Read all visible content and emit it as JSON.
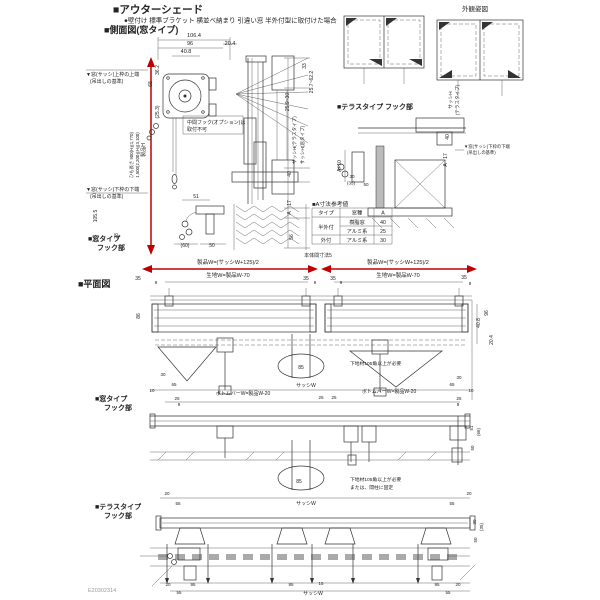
{
  "colors": {
    "accent_red": "#c00000",
    "line": "#2b2b2b",
    "bg": "#ffffff"
  },
  "header": {
    "title": "■アウターシェード",
    "subtitle": "●壁付け 標準ブラケット 横並べ納まり 引違い窓 半外付型に取付けた場合",
    "side_view_heading": "■側面図(窓タイプ)",
    "exterior_view_label": "外観姿図",
    "plan_heading": "■平面図"
  },
  "section_labels": {
    "window_hook_side_line1": "■窓タイプ",
    "window_hook_side_line2": "フック部",
    "terrace_hook_side": "■テラスタイプ フック部",
    "window_hook_plan_line1": "■窓タイプ",
    "window_hook_plan_line2": "フック部",
    "terrace_hook_plan_line1": "■テラスタイプ",
    "terrace_hook_plan_line2": "フック部"
  },
  "table": {
    "title": "■A寸法参考値",
    "headers": [
      "タイプ",
      "窓種",
      "A"
    ],
    "rows": [
      [
        "半外付",
        "樹脂窓",
        "40"
      ],
      [
        "",
        "アルミ系",
        "25"
      ],
      [
        "外付",
        "アルミ系",
        "30"
      ]
    ]
  },
  "footer": {
    "code": "E20302314"
  },
  "labels": [
    {
      "n": "dim-total-depth",
      "t": "106.4",
      "x": 194,
      "y": 37,
      "s": 5.5
    },
    {
      "n": "dim-96",
      "t": "96",
      "x": 190,
      "y": 45,
      "s": 5.5
    },
    {
      "n": "dim-20-4",
      "t": "20.4",
      "x": 230,
      "y": 45,
      "s": 5.5
    },
    {
      "n": "dim-40-8",
      "t": "40.8",
      "x": 186,
      "y": 53,
      "s": 5.5
    },
    {
      "n": "dim-36-2",
      "t": "36.2",
      "x": 159,
      "y": 70,
      "r": -90,
      "s": 5
    },
    {
      "n": "dim-68",
      "t": "68",
      "x": 152,
      "y": 84,
      "r": -90,
      "s": 5
    },
    {
      "n": "dim-25-3",
      "t": "(25.3)",
      "x": 159,
      "y": 112,
      "r": -90,
      "s": 5
    },
    {
      "n": "ref-top-frame-note1",
      "t": "▼窓(サッシ)上枠の上端",
      "x": 86,
      "y": 76,
      "s": 5,
      "a": "start"
    },
    {
      "n": "ref-top-frame-note2",
      "t": "(吊出しの基準)",
      "x": 90,
      "y": 83,
      "s": 5,
      "a": "start"
    },
    {
      "n": "ref-bottom-frame-note1",
      "t": "▼窓(サッシ)下枠の下端",
      "x": 86,
      "y": 191,
      "s": 5,
      "a": "start"
    },
    {
      "n": "ref-bottom-frame-note2",
      "t": "(吊出しの基準)",
      "x": 90,
      "y": 198,
      "s": 5,
      "a": "start"
    },
    {
      "n": "dim-product-height",
      "t": "製品H",
      "x": 145,
      "y": 150,
      "r": -90,
      "s": 5
    },
    {
      "n": "cord-length-note1",
      "t": "ひも長さ 900(H≦1,770)",
      "x": 133,
      "y": 155,
      "r": -90,
      "s": 4.3
    },
    {
      "n": "cord-length-note2",
      "t": "1,500(2,200≦H≦3,100)",
      "x": 139,
      "y": 155,
      "r": -90,
      "s": 4.3
    },
    {
      "n": "dim-105-5",
      "t": "105.5",
      "x": 97,
      "y": 216,
      "r": -90,
      "s": 5
    },
    {
      "n": "dim-28",
      "t": "28",
      "x": 118,
      "y": 236,
      "r": -90,
      "s": 5
    },
    {
      "n": "mid-hook-note1",
      "t": "中間フック(オプション)は",
      "x": 187,
      "y": 124,
      "s": 5,
      "a": "start"
    },
    {
      "n": "mid-hook-note2",
      "t": "取付不可",
      "x": 187,
      "y": 131,
      "s": 5,
      "a": "start"
    },
    {
      "n": "dim-51",
      "t": "51",
      "x": 196,
      "y": 198,
      "s": 5
    },
    {
      "n": "dim-60",
      "t": "(60)",
      "x": 185,
      "y": 247,
      "s": 5
    },
    {
      "n": "dim-50",
      "t": "50",
      "x": 212,
      "y": 247,
      "s": 5
    },
    {
      "n": "dim-33",
      "t": "33",
      "x": 306,
      "y": 66,
      "r": -90,
      "s": 5
    },
    {
      "n": "dim-25-7-62-2",
      "t": "25.7~62.2",
      "x": 313,
      "y": 82,
      "r": -90,
      "s": 5
    },
    {
      "n": "dim-25-9-30",
      "t": "25.9~30",
      "x": 289,
      "y": 102,
      "r": -90,
      "s": 5
    },
    {
      "n": "dim-sash-h-terrace",
      "t": "サッシH(テラスタイプ)",
      "x": 296,
      "y": 140,
      "r": -90,
      "s": 4.6
    },
    {
      "n": "dim-sash-h-window",
      "t": "サッシH(窓タイプ)",
      "x": 304,
      "y": 145,
      "r": -90,
      "s": 4.6
    },
    {
      "n": "dim-40",
      "t": "40",
      "x": 291,
      "y": 174,
      "r": -90,
      "s": 5
    },
    {
      "n": "dim-17",
      "t": "17",
      "x": 291,
      "y": 203,
      "r": -90,
      "s": 5
    },
    {
      "n": "dim-a",
      "t": "A",
      "x": 291,
      "y": 213,
      "r": -90,
      "s": 5
    },
    {
      "n": "dim-56",
      "t": "56",
      "x": 293,
      "y": 237,
      "r": -90,
      "s": 5
    },
    {
      "n": "dim-sash-h-terrace2a",
      "t": "サッシH",
      "x": 452,
      "y": 100,
      "r": -90,
      "s": 4.6
    },
    {
      "n": "dim-sash-h-terrace2b",
      "t": "(テラスタイプ)",
      "x": 459,
      "y": 100,
      "r": -90,
      "s": 4.6
    },
    {
      "n": "dim-t-40",
      "t": "40",
      "x": 449,
      "y": 137,
      "r": -90,
      "s": 5
    },
    {
      "n": "dim-t-17",
      "t": "17",
      "x": 447,
      "y": 156,
      "r": -90,
      "s": 5
    },
    {
      "n": "dim-t-a",
      "t": "A",
      "x": 447,
      "y": 165,
      "r": -90,
      "s": 5
    },
    {
      "n": "dim-a-plus-10",
      "t": "A+10",
      "x": 341,
      "y": 166,
      "r": -90,
      "s": 5
    },
    {
      "n": "t-ref-note1",
      "t": "▼窓(サッシ)下枠の下端",
      "x": 464,
      "y": 148,
      "s": 4.3,
      "a": "start"
    },
    {
      "n": "t-ref-note2",
      "t": "(吊出しの基準)",
      "x": 467,
      "y": 154,
      "s": 4.3,
      "a": "start"
    },
    {
      "n": "dim-t-30",
      "t": "30",
      "x": 352,
      "y": 178,
      "s": 4.5
    },
    {
      "n": "dim-t-35",
      "t": "(35)",
      "x": 351,
      "y": 184.5,
      "s": 4.5
    },
    {
      "n": "dim-t-50",
      "t": "50",
      "x": 366,
      "y": 186,
      "s": 4.5
    },
    {
      "n": "plan-product-w-left",
      "t": "製品W=(サッシW+125)/2",
      "x": 228,
      "y": 264,
      "s": 5.5,
      "c": "red"
    },
    {
      "n": "plan-fabric-w-left",
      "t": "生地W=製品W-70",
      "x": 228,
      "y": 277,
      "s": 5.5
    },
    {
      "n": "plan-product-w-right",
      "t": "製品W=(サッシW+125)/2",
      "x": 398,
      "y": 264,
      "s": 5.5,
      "c": "red"
    },
    {
      "n": "plan-fabric-w-right",
      "t": "生地W=製品W-70",
      "x": 398,
      "y": 277,
      "s": 5.5
    },
    {
      "n": "plan-body-gap",
      "t": "本体間寸法5",
      "x": 318,
      "y": 257,
      "s": 5
    },
    {
      "t": "35",
      "x": 138,
      "y": 280,
      "s": 5,
      "c": "red"
    },
    {
      "t": "35",
      "x": 306,
      "y": 280,
      "s": 5,
      "c": "red"
    },
    {
      "t": "35",
      "x": 333,
      "y": 280,
      "s": 5,
      "c": "red"
    },
    {
      "t": "35",
      "x": 464,
      "y": 279,
      "s": 5,
      "c": "red"
    },
    {
      "t": "9",
      "x": 156,
      "y": 284,
      "s": 4.5
    },
    {
      "t": "9",
      "x": 315,
      "y": 284,
      "s": 4.5
    },
    {
      "t": "9",
      "x": 341,
      "y": 284,
      "s": 4.5
    },
    {
      "t": "9",
      "x": 470,
      "y": 285,
      "s": 4.5
    },
    {
      "n": "dim-86",
      "t": "86",
      "x": 140,
      "y": 316,
      "r": -90,
      "s": 5
    },
    {
      "n": "dim-96b",
      "t": "96",
      "x": 488,
      "y": 313,
      "r": -90,
      "s": 5
    },
    {
      "n": "dim-40-8b",
      "t": "40.8",
      "x": 480,
      "y": 323,
      "r": -90,
      "s": 5
    },
    {
      "n": "dim-20-4b",
      "t": "20.4",
      "x": 493,
      "y": 340,
      "r": -90,
      "s": 5
    },
    {
      "t": "30",
      "x": 163,
      "y": 376,
      "s": 4.5
    },
    {
      "t": "65",
      "x": 174,
      "y": 386,
      "s": 4.5
    },
    {
      "t": "10",
      "x": 152,
      "y": 392,
      "s": 4.5
    },
    {
      "t": "25",
      "x": 177,
      "y": 400,
      "s": 4.5
    },
    {
      "t": "9",
      "x": 179,
      "y": 406,
      "s": 4.5
    },
    {
      "t": "30",
      "x": 459,
      "y": 379,
      "s": 4.5
    },
    {
      "t": "65",
      "x": 452,
      "y": 386,
      "s": 4.5
    },
    {
      "t": "10",
      "x": 471,
      "y": 392,
      "s": 4.5
    },
    {
      "t": "25",
      "x": 459,
      "y": 400,
      "s": 4.5
    },
    {
      "t": "9",
      "x": 458,
      "y": 406,
      "s": 4.5
    },
    {
      "n": "bottom-bar-w-left",
      "t": "ボトムバーW=製品W-20",
      "x": 243,
      "y": 395,
      "s": 5
    },
    {
      "n": "bottom-bar-w-right",
      "t": "ボトムバーW=製品W-20",
      "x": 389,
      "y": 393,
      "s": 5
    },
    {
      "n": "sash-w-row1",
      "t": "サッシW",
      "x": 306,
      "y": 387,
      "s": 5
    },
    {
      "t": "25",
      "x": 321,
      "y": 399,
      "s": 4.5
    },
    {
      "t": "25",
      "x": 334,
      "y": 399,
      "s": 4.5
    },
    {
      "n": "detail-85-row1",
      "t": "85",
      "x": 301,
      "y": 369,
      "s": 5
    },
    {
      "n": "base-note-row1",
      "t": "下地材105角以上が必要",
      "x": 350,
      "y": 365,
      "s": 4.8,
      "a": "start"
    },
    {
      "n": "detail-85-row2",
      "t": "85",
      "x": 299,
      "y": 483,
      "s": 5
    },
    {
      "n": "base-note-row2a",
      "t": "下地材105角以上が必要",
      "x": 350,
      "y": 481,
      "s": 4.8,
      "a": "start"
    },
    {
      "n": "base-note-row2b",
      "t": "または、間柱に固定",
      "x": 350,
      "y": 489,
      "s": 4.8,
      "a": "start"
    },
    {
      "t": "51",
      "x": 473,
      "y": 428,
      "r": -90,
      "s": 4.5
    },
    {
      "t": "(66)",
      "x": 480,
      "y": 432,
      "r": -90,
      "s": 4.5
    },
    {
      "t": "50",
      "x": 474,
      "y": 448,
      "r": -90,
      "s": 4.5
    },
    {
      "t": "20",
      "x": 167,
      "y": 495,
      "s": 4.5
    },
    {
      "t": "55",
      "x": 178,
      "y": 505,
      "s": 4.5
    },
    {
      "t": "20",
      "x": 469,
      "y": 495,
      "s": 4.5
    },
    {
      "t": "55",
      "x": 452,
      "y": 505,
      "s": 4.5
    },
    {
      "n": "sash-w-row2",
      "t": "サッシW",
      "x": 306,
      "y": 505,
      "s": 5
    },
    {
      "t": "30",
      "x": 476,
      "y": 522,
      "r": -90,
      "s": 4.5
    },
    {
      "t": "(35)",
      "x": 483,
      "y": 527,
      "r": -90,
      "s": 4.5
    },
    {
      "t": "50",
      "x": 477,
      "y": 540,
      "r": -90,
      "s": 4.5
    },
    {
      "t": "20",
      "x": 168,
      "y": 586,
      "s": 4.5
    },
    {
      "t": "95",
      "x": 193,
      "y": 586,
      "s": 4.5
    },
    {
      "t": "55",
      "x": 179,
      "y": 594,
      "s": 4.5
    },
    {
      "t": "95",
      "x": 291,
      "y": 586,
      "s": 4.5
    },
    {
      "t": "15",
      "x": 321,
      "y": 585,
      "s": 4.5
    },
    {
      "t": "95",
      "x": 437,
      "y": 586,
      "s": 4.5
    },
    {
      "t": "20",
      "x": 458,
      "y": 586,
      "s": 4.5
    },
    {
      "t": "55",
      "x": 448,
      "y": 594,
      "s": 4.5
    },
    {
      "n": "sash-w-row3",
      "t": "サッシW",
      "x": 313,
      "y": 595,
      "s": 5
    }
  ]
}
